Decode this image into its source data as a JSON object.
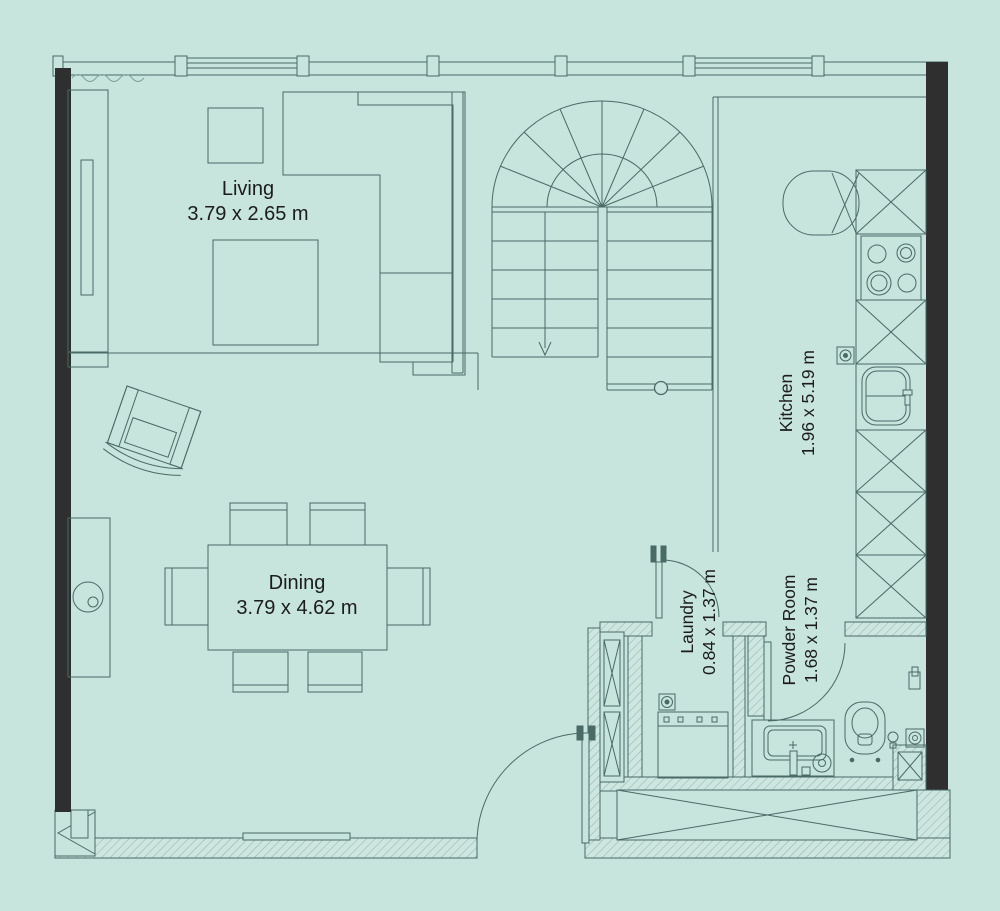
{
  "plan": {
    "type": "residential-floor-plan",
    "rooms": [
      {
        "id": "living",
        "name": "Living",
        "dimensions": "3.79 x 2.65 m",
        "label_orientation": "horizontal"
      },
      {
        "id": "dining",
        "name": "Dining",
        "dimensions": "3.79 x 4.62 m",
        "label_orientation": "horizontal"
      },
      {
        "id": "kitchen",
        "name": "Kitchen",
        "dimensions": "1.96 x 5.19 m",
        "label_orientation": "vertical"
      },
      {
        "id": "laundry",
        "name": "Laundry",
        "dimensions": "0.84 x 1.37 m",
        "label_orientation": "vertical"
      },
      {
        "id": "powder-room",
        "name": "Powder Room",
        "dimensions": "1.68 x 1.37 m",
        "label_orientation": "vertical"
      }
    ],
    "colors": {
      "background": "#c7e4dd",
      "wall_black": "#2e2f2e",
      "line": "#4a6a66",
      "hatch": "#93b5ae",
      "text": "#1c1c1c"
    },
    "features": [
      "u-shaped-winder-staircase",
      "down-arrow",
      "sectional-sofa",
      "tv-console",
      "coffee-table",
      "rug",
      "armchair",
      "dining-table-six-chairs",
      "sideboard",
      "kitchen-counter",
      "cooktop-4-burner",
      "kitchen-sink",
      "refrigerator",
      "washing-machine",
      "toilet",
      "vanity-sink",
      "floor-drain",
      "entry-door-swing",
      "laundry-door-swing",
      "powder-door-swing",
      "storage-closets",
      "windows-top-wall",
      "curtain-symbol"
    ]
  }
}
